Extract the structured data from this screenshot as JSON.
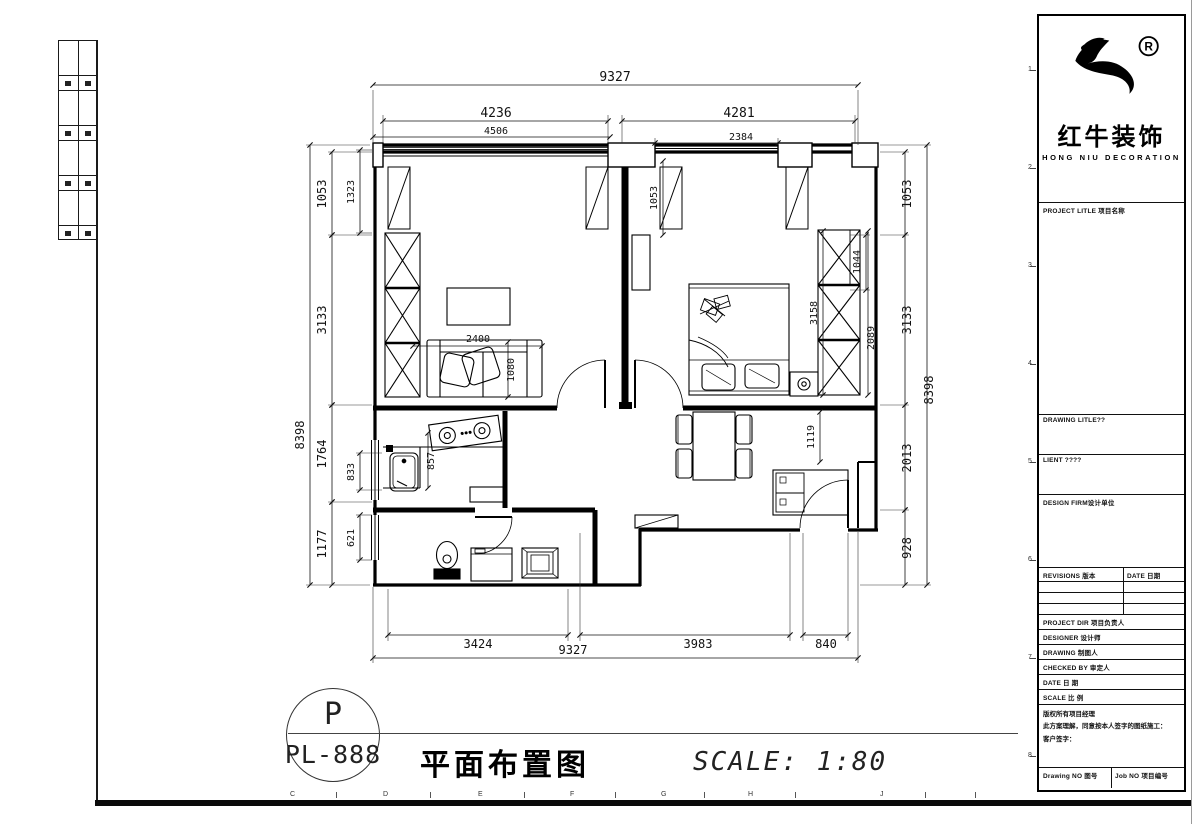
{
  "footer": {
    "sheet_letter": "P",
    "sheet_no": "PL-888",
    "title": "平面布置图",
    "scale": "SCALE: 1:80"
  },
  "titleblock": {
    "brand": {
      "cn": "红牛装饰",
      "en": "HONG NIU DECORATION",
      "reg": "R"
    },
    "fields": {
      "project_title": "PROJECT LITLE 项目名称",
      "drawing_title": "DRAWING LITLE??",
      "client": "LIENT ????",
      "design_firm": "DESIGN FIRM设计单位",
      "revisions": "REVISIONS 版本",
      "date_col": "DATE 日期",
      "project_dir": "PROJECT DIR  项目负责人",
      "designer": "DESIGNER    设计师",
      "drawing": "DRAWING    制图人",
      "checked_by": "CHECKED BY  审定人",
      "date": "DATE      日 期",
      "scale": "SCALE     比 例",
      "note1": "版权所有项目经理",
      "note2": "此方案理解，同意按本人签字的图纸施工：",
      "note3": "客户签字：",
      "drawing_no": "Drawing NO 图号",
      "job_no": "Job NO 项目编号"
    }
  },
  "colors": {
    "line": "#000000",
    "background": "#ffffff"
  },
  "page": {
    "grid_letters": [
      {
        "t": "C",
        "x": 290
      },
      {
        "t": "D",
        "x": 383
      },
      {
        "t": "E",
        "x": 478
      },
      {
        "t": "F",
        "x": 570
      },
      {
        "t": "G",
        "x": 661
      },
      {
        "t": "H",
        "x": 748
      },
      {
        "t": "J",
        "x": 880
      }
    ],
    "grid_ticks": [
      336,
      430,
      524,
      615,
      704,
      795,
      925,
      975
    ],
    "grid_numbers": [
      {
        "t": "1",
        "y": 70
      },
      {
        "t": "2",
        "y": 168
      },
      {
        "t": "3",
        "y": 266
      },
      {
        "t": "4",
        "y": 364
      },
      {
        "t": "5",
        "y": 462
      },
      {
        "t": "6",
        "y": 560
      },
      {
        "t": "7",
        "y": 658
      },
      {
        "t": "8",
        "y": 756
      }
    ]
  },
  "floor_plan": {
    "dims": [
      {
        "t": "9327",
        "x1": 83,
        "y1": 30,
        "x2": 568,
        "y2": 30,
        "lx": 325,
        "ly": 26,
        "rot": 0,
        "fs": 13
      },
      {
        "t": "4236",
        "x1": 93,
        "y1": 66,
        "x2": 318,
        "y2": 66,
        "lx": 206,
        "ly": 62,
        "rot": 0,
        "fs": 13
      },
      {
        "t": "4281",
        "x1": 332,
        "y1": 66,
        "x2": 565,
        "y2": 66,
        "lx": 449,
        "ly": 62,
        "rot": 0,
        "fs": 13
      },
      {
        "t": "4506",
        "x1": 83,
        "y1": 82,
        "x2": 320,
        "y2": 82,
        "lx": 206,
        "ly": 79,
        "rot": 0,
        "fs": 10
      },
      {
        "t": "2384",
        "x1": 365,
        "y1": 88,
        "x2": 488,
        "y2": 88,
        "lx": 451,
        "ly": 85,
        "rot": 0,
        "fs": 10
      },
      {
        "t": "3424",
        "x1": 98,
        "y1": 580,
        "x2": 278,
        "y2": 580,
        "lx": 188,
        "ly": 593,
        "rot": 0,
        "fs": 12
      },
      {
        "t": "3983",
        "x1": 290,
        "y1": 580,
        "x2": 500,
        "y2": 580,
        "lx": 408,
        "ly": 593,
        "rot": 0,
        "fs": 12
      },
      {
        "t": "840",
        "x1": 513,
        "y1": 580,
        "x2": 558,
        "y2": 580,
        "lx": 536,
        "ly": 593,
        "rot": 0,
        "fs": 12
      },
      {
        "t": "9327",
        "x1": 83,
        "y1": 603,
        "x2": 568,
        "y2": 603,
        "lx": 283,
        "ly": 599,
        "rot": 0,
        "fs": 12
      },
      {
        "t": "8398",
        "x1": 20,
        "y1": 90,
        "x2": 20,
        "y2": 530,
        "lx": 14,
        "ly": 380,
        "rot": -90,
        "fs": 12
      },
      {
        "t": "1053",
        "x1": 42,
        "y1": 97,
        "x2": 42,
        "y2": 180,
        "lx": 36,
        "ly": 139,
        "rot": -90,
        "fs": 12
      },
      {
        "t": "3133",
        "x1": 42,
        "y1": 180,
        "x2": 42,
        "y2": 350,
        "lx": 36,
        "ly": 265,
        "rot": -90,
        "fs": 12
      },
      {
        "t": "1764",
        "x1": 42,
        "y1": 350,
        "x2": 42,
        "y2": 447,
        "lx": 36,
        "ly": 399,
        "rot": -90,
        "fs": 12
      },
      {
        "t": "1177",
        "x1": 42,
        "y1": 447,
        "x2": 42,
        "y2": 530,
        "lx": 36,
        "ly": 489,
        "rot": -90,
        "fs": 12
      },
      {
        "t": "1323",
        "x1": 70,
        "y1": 95,
        "x2": 70,
        "y2": 178,
        "lx": 64,
        "ly": 137,
        "rot": -90,
        "fs": 10
      },
      {
        "t": "833",
        "x1": 70,
        "y1": 398,
        "x2": 70,
        "y2": 435,
        "lx": 64,
        "ly": 417,
        "rot": -90,
        "fs": 10
      },
      {
        "t": "621",
        "x1": 70,
        "y1": 460,
        "x2": 70,
        "y2": 505,
        "lx": 64,
        "ly": 483,
        "rot": -90,
        "fs": 10
      },
      {
        "t": "1053",
        "x1": 615,
        "y1": 97,
        "x2": 615,
        "y2": 180,
        "lx": 621,
        "ly": 139,
        "rot": -90,
        "fs": 12
      },
      {
        "t": "3133",
        "x1": 615,
        "y1": 180,
        "x2": 615,
        "y2": 350,
        "lx": 621,
        "ly": 265,
        "rot": -90,
        "fs": 12
      },
      {
        "t": "2013",
        "x1": 615,
        "y1": 350,
        "x2": 615,
        "y2": 455,
        "lx": 621,
        "ly": 403,
        "rot": -90,
        "fs": 12
      },
      {
        "t": "928",
        "x1": 615,
        "y1": 455,
        "x2": 615,
        "y2": 530,
        "lx": 621,
        "ly": 493,
        "rot": -90,
        "fs": 12
      },
      {
        "t": "8398",
        "x1": 637,
        "y1": 90,
        "x2": 637,
        "y2": 530,
        "lx": 643,
        "ly": 335,
        "rot": -90,
        "fs": 12
      },
      {
        "t": "1044",
        "x1": 576,
        "y1": 180,
        "x2": 576,
        "y2": 235,
        "lx": 570,
        "ly": 207,
        "rot": -90,
        "fs": 10
      },
      {
        "t": "1053",
        "x1": 373,
        "y1": 106,
        "x2": 373,
        "y2": 180,
        "lx": 367,
        "ly": 143,
        "rot": -90,
        "fs": 10
      },
      {
        "t": "3158",
        "x1": 533,
        "y1": 176,
        "x2": 533,
        "y2": 340,
        "lx": 527,
        "ly": 258,
        "rot": -90,
        "fs": 10
      },
      {
        "t": "2089",
        "x1": 578,
        "y1": 176,
        "x2": 578,
        "y2": 340,
        "lx": 584,
        "ly": 283,
        "rot": -90,
        "fs": 10
      },
      {
        "t": "2400",
        "x1": 123,
        "y1": 291,
        "x2": 252,
        "y2": 291,
        "lx": 188,
        "ly": 287,
        "rot": 0,
        "fs": 10
      },
      {
        "t": "1080",
        "x1": 218,
        "y1": 287,
        "x2": 218,
        "y2": 342,
        "lx": 224,
        "ly": 315,
        "rot": -90,
        "fs": 10
      },
      {
        "t": "857",
        "x1": 138,
        "y1": 378,
        "x2": 138,
        "y2": 433,
        "lx": 144,
        "ly": 406,
        "rot": -90,
        "fs": 10
      },
      {
        "t": "1119",
        "x1": 530,
        "y1": 357,
        "x2": 530,
        "y2": 407,
        "lx": 524,
        "ly": 382,
        "rot": -90,
        "fs": 10
      }
    ]
  }
}
